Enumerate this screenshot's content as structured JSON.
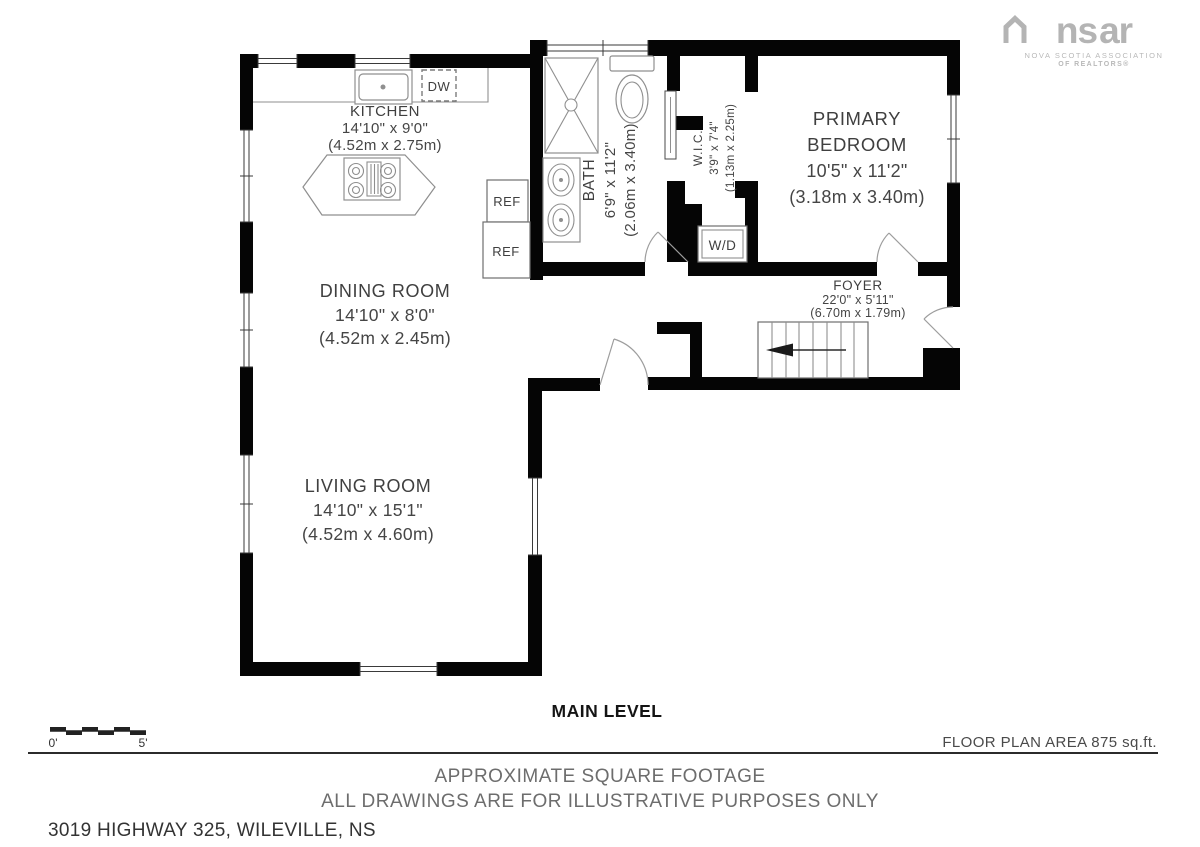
{
  "logo": {
    "wordmark_left": "ns",
    "wordmark_right": "ar",
    "line1": "NOVA SCOTIA ASSOCIATION",
    "line2": "OF REALTORS®"
  },
  "rooms": {
    "kitchen": {
      "name": "KITCHEN",
      "imperial": "14'10\" x 9'0\"",
      "metric": "(4.52m x 2.75m)"
    },
    "dining": {
      "name": "DINING ROOM",
      "imperial": "14'10\" x 8'0\"",
      "metric": "(4.52m x 2.45m)"
    },
    "living": {
      "name": "LIVING ROOM",
      "imperial": "14'10\" x 15'1\"",
      "metric": "(4.52m x 4.60m)"
    },
    "bath": {
      "name": "BATH",
      "imperial": "6'9\" x 11'2\"",
      "metric": "(2.06m x 3.40m)"
    },
    "wic": {
      "name": "W.I.C.",
      "imperial": "3'9\" x 7'4\"",
      "metric": "(1.13m x 2.25m)"
    },
    "bedroom": {
      "name_line1": "PRIMARY",
      "name_line2": "BEDROOM",
      "imperial": "10'5\" x 11'2\"",
      "metric": "(3.18m x 3.40m)"
    },
    "foyer": {
      "name": "FOYER",
      "imperial": "22'0\" x 5'11\"",
      "metric": "(6.70m x 1.79m)"
    }
  },
  "appliances": {
    "dishwasher": "DW",
    "fridge_top": "REF",
    "fridge_bottom": "REF",
    "washer_dryer": "W/D"
  },
  "level_title": "MAIN LEVEL",
  "scale_bar": {
    "start": "0'",
    "end": "5'"
  },
  "footer": {
    "area": "FLOOR PLAN AREA 875 sq.ft.",
    "disclaimer1": "APPROXIMATE SQUARE FOOTAGE",
    "disclaimer2": "ALL DRAWINGS ARE FOR ILLUSTRATIVE PURPOSES ONLY",
    "address": "3019 HIGHWAY 325, WILEVILLE, NS"
  },
  "colors": {
    "wall": "#050505",
    "label_text": "#3f3f3f",
    "muted_text": "#6d6d6d",
    "logo_gray": "#b4b4b4"
  }
}
